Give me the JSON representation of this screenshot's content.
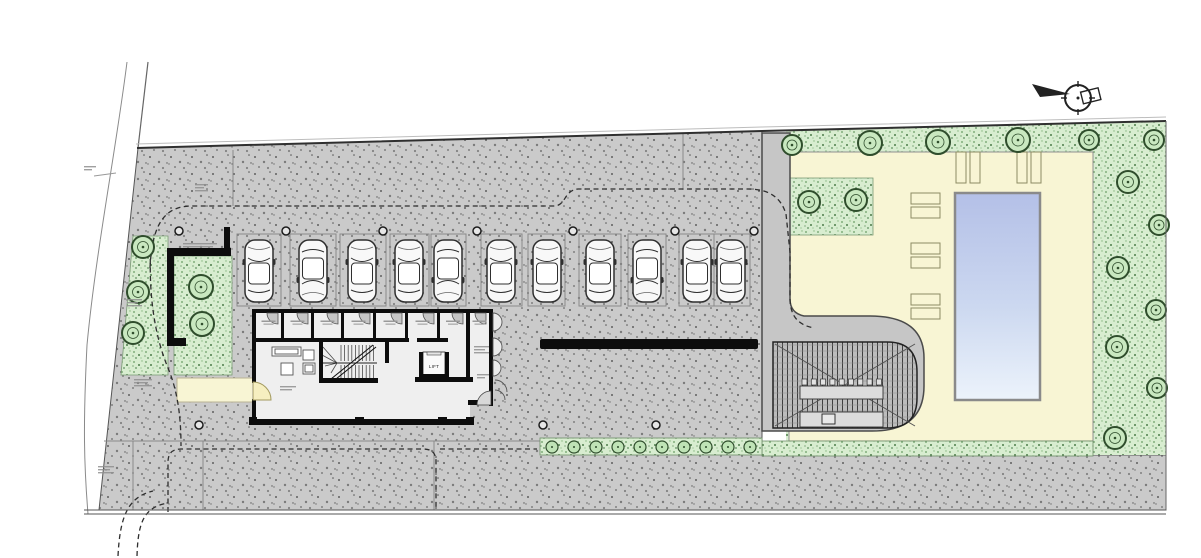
{
  "plan": {
    "type": "architectural ground-floor site plan",
    "features": [
      "surface parking row",
      "residential lobby block",
      "basement ramp",
      "swimming pool and deck",
      "lawns with trees",
      "boundary road"
    ]
  },
  "colors": {
    "paving": "#cacaca",
    "paving_speckle": "#5f5f5f",
    "lawn": "#d8edd0",
    "lawn_speckle": "#4e7d4a",
    "deck": "#f8f5d4",
    "pool_top": "#b4c0e7",
    "pool_bottom": "#ecf3fb",
    "wall": "#0d0d0d",
    "driveway": "#c6c6c6",
    "ramp_base": "#bcbcbc",
    "tree_fill": "#c9e8c0",
    "tree_stroke": "#2f4d2c",
    "door_highlight": "#f6efc0",
    "floor": "#efefef"
  },
  "parking": {
    "bay_y": 234,
    "bay_h": 72,
    "bays": [
      [
        237,
        44
      ],
      [
        290,
        46
      ],
      [
        340,
        46
      ],
      [
        390,
        39
      ],
      [
        431,
        35
      ],
      [
        481,
        41
      ],
      [
        528,
        37
      ],
      [
        579,
        42
      ],
      [
        628,
        38
      ],
      [
        679,
        71
      ]
    ],
    "double_bay_divider_x": 714,
    "car_y": 271,
    "cars": [
      [
        259,
        0
      ],
      [
        313,
        1
      ],
      [
        362,
        0
      ],
      [
        409,
        0
      ],
      [
        448,
        1
      ],
      [
        501,
        0
      ],
      [
        547,
        0
      ],
      [
        600,
        0
      ],
      [
        647,
        1
      ],
      [
        697,
        0
      ],
      [
        731,
        0
      ]
    ],
    "bollards": [
      [
        286,
        231
      ],
      [
        383,
        231
      ],
      [
        477,
        231
      ],
      [
        573,
        231
      ],
      [
        675,
        231
      ],
      [
        754,
        231
      ],
      [
        179,
        231
      ],
      [
        199,
        425
      ],
      [
        543,
        425
      ],
      [
        656,
        425
      ]
    ]
  },
  "building": {
    "rooms": [
      [
        256,
        281
      ],
      [
        284,
        311
      ],
      [
        314,
        341
      ],
      [
        344,
        373
      ],
      [
        376,
        405
      ],
      [
        408,
        437
      ],
      [
        440,
        466
      ]
    ],
    "wing": [
      470,
      489
    ],
    "lift": {
      "x": 434,
      "y": 368,
      "label": "LIFT"
    }
  },
  "landscape": {
    "trees": [
      [
        143,
        247,
        11
      ],
      [
        138,
        292,
        11
      ],
      [
        133,
        333,
        11
      ],
      [
        201,
        287,
        12
      ],
      [
        202,
        324,
        12
      ],
      [
        809,
        202,
        11
      ],
      [
        856,
        200,
        11
      ],
      [
        792,
        145,
        10
      ],
      [
        870,
        143,
        12
      ],
      [
        938,
        142,
        12
      ],
      [
        1018,
        140,
        12
      ],
      [
        1089,
        140,
        10
      ],
      [
        1154,
        140,
        10
      ],
      [
        1128,
        182,
        11
      ],
      [
        1159,
        225,
        10
      ],
      [
        1118,
        268,
        11
      ],
      [
        1156,
        310,
        10
      ],
      [
        1117,
        347,
        11
      ],
      [
        1157,
        388,
        10
      ],
      [
        1115,
        438,
        11
      ]
    ],
    "hedge_shrubs_y": 447,
    "hedge_shrubs_x": [
      552,
      574,
      596,
      618,
      640,
      662,
      684,
      706,
      728,
      750
    ]
  },
  "pool_area": {
    "loungers_left": [
      [
        911,
        193
      ],
      [
        911,
        207
      ],
      [
        911,
        243
      ],
      [
        911,
        257
      ],
      [
        911,
        294
      ],
      [
        911,
        308
      ]
    ],
    "lounger_left_size": [
      29,
      11
    ],
    "loungers_top": [
      [
        956,
        152
      ],
      [
        970,
        152
      ],
      [
        1017,
        152
      ],
      [
        1031,
        152
      ]
    ],
    "lounger_top_size": [
      10,
      31
    ]
  },
  "annotations": [
    [
      195,
      184,
      3,
      13
    ],
    [
      183,
      243,
      2,
      34
    ],
    [
      127,
      299,
      3,
      15
    ],
    [
      134,
      379,
      3,
      18
    ],
    [
      98,
      466,
      3,
      16
    ],
    [
      280,
      386,
      2,
      16
    ],
    [
      474,
      346,
      3,
      15
    ],
    [
      477,
      374,
      2,
      12
    ],
    [
      84,
      166,
      2,
      12
    ]
  ]
}
